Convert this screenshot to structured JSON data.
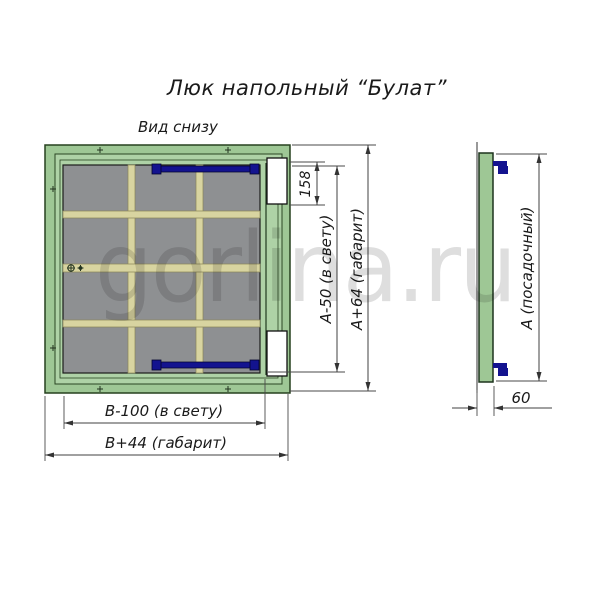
{
  "title": "Люк напольный “Булат”",
  "view_label": "Вид снизу",
  "watermark": "gorlina.ru",
  "main_view": {
    "dim_hinge": "158",
    "dim_height_clear": "А-50 (в свету)",
    "dim_height_overall": "А+64 (габарит)",
    "dim_width_clear": "В-100 (в свету)",
    "dim_width_overall": "В+44 (габарит)"
  },
  "side_view": {
    "dim_seat": "А (посадочный)",
    "dim_depth": "60"
  },
  "colors": {
    "frame_green": "#9ec795",
    "lid_green": "#aed2a6",
    "panel_gray": "#8e9092",
    "rib_beige": "#d8d4a0",
    "hinge_navy": "#13138f",
    "cutout_white": "#ffffff",
    "outline": "#27411f",
    "watermark_gray": "#dedede"
  }
}
